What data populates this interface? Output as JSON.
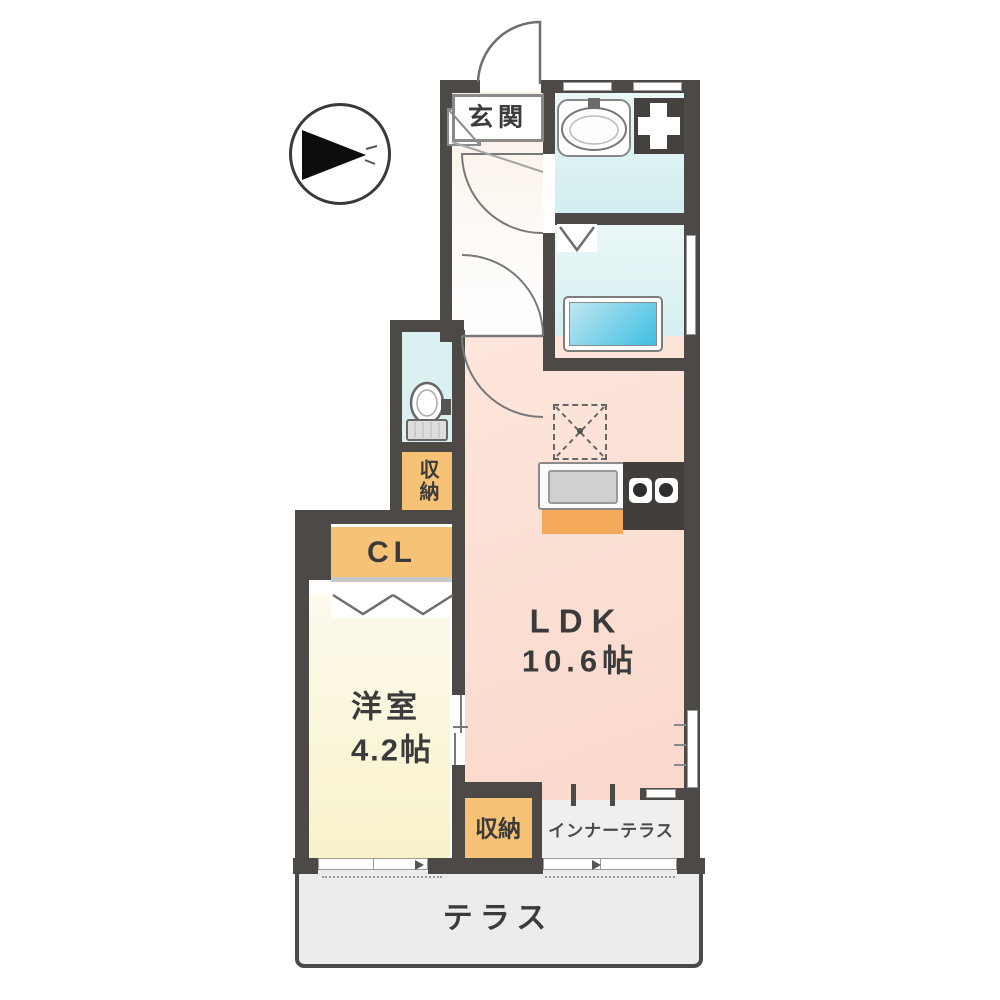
{
  "floorplan": {
    "compass": {
      "type": "direction-arrow",
      "points": "right"
    },
    "labels": {
      "entrance": "玄関",
      "ldk_name": "LDK",
      "ldk_size": "10.6帖",
      "bedroom_name": "洋室",
      "bedroom_size": "4.2帖",
      "closet": "CL",
      "storage_hall": "収納",
      "storage_ldk": "収納",
      "inner_terrace": "インナーテラス",
      "terrace": "テラス"
    },
    "fixtures": [
      "entrance-door",
      "shoe-cabinet",
      "wash-basin",
      "washing-machine-space",
      "bathtub",
      "toilet",
      "refrigerator-space",
      "kitchen-sink",
      "gas-stove",
      "kitchen-cabinet",
      "closet-folding-doors",
      "bathroom-folding-door",
      "sliding-door",
      "windows"
    ],
    "colors": {
      "wall": "#4c4947",
      "wet_area_floor": "#ddf1f2",
      "ldk_floor": "#fbdccd",
      "bedroom_floor": "#fbf5d8",
      "storage_fill": "#f6c276",
      "kitchen_cabinet_fill": "#f5a95a",
      "terrace_floor": "#ececec",
      "bathtub_fill_light": "#bfe6f2",
      "bathtub_fill_dark": "#44c1e2",
      "label_text": "#3b3b3b"
    }
  }
}
